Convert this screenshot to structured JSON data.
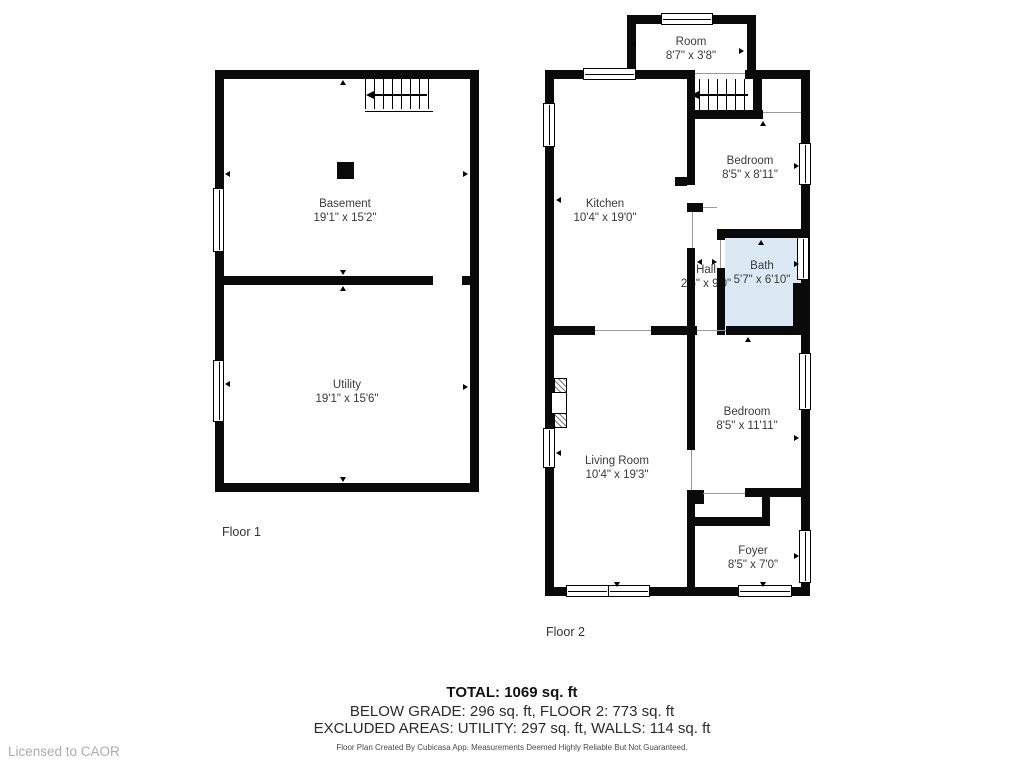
{
  "meta": {
    "type": "floor-plan",
    "app_credit": "Cubicasa"
  },
  "colors": {
    "wall": "#0a0a0a",
    "bath_fill": "#dbe9f5",
    "room_text": "#3a3a3a",
    "licensed_text": "#a9aeb5"
  },
  "floor1": {
    "label": "Floor 1",
    "rooms": [
      {
        "name": "Basement",
        "dims": "19'1\" x 15'2\""
      },
      {
        "name": "Utility",
        "dims": "19'1\" x 15'6\""
      }
    ]
  },
  "floor2": {
    "label": "Floor 2",
    "rooms": [
      {
        "name": "Room",
        "dims": "8'7\" x 3'8\""
      },
      {
        "name": "Kitchen",
        "dims": "10'4\" x 19'0\""
      },
      {
        "name": "Bedroom",
        "dims": "8'5\" x 8'11\""
      },
      {
        "name": "Hall",
        "dims": "2'6\" x 9'0\""
      },
      {
        "name": "Bath",
        "dims": "5'7\" x 6'10\""
      },
      {
        "name": "Living Room",
        "dims": "10'4\" x 19'3\""
      },
      {
        "name": "Bedroom",
        "dims": "8'5\" x 11'11\""
      },
      {
        "name": "Foyer",
        "dims": "8'5\" x 7'0\""
      }
    ]
  },
  "summary": {
    "total": "TOTAL: 1069 sq. ft",
    "line2": "BELOW GRADE: 296 sq. ft, FLOOR 2: 773 sq. ft",
    "line3": "EXCLUDED AREAS: UTILITY: 297 sq. ft, WALLS: 114 sq. ft",
    "disclaimer": "Floor Plan Created By Cubicasa App. Measurements Deemed Highly Reliable But Not Guaranteed."
  },
  "branding": {
    "licensed_to": "Licensed to CAOR"
  }
}
